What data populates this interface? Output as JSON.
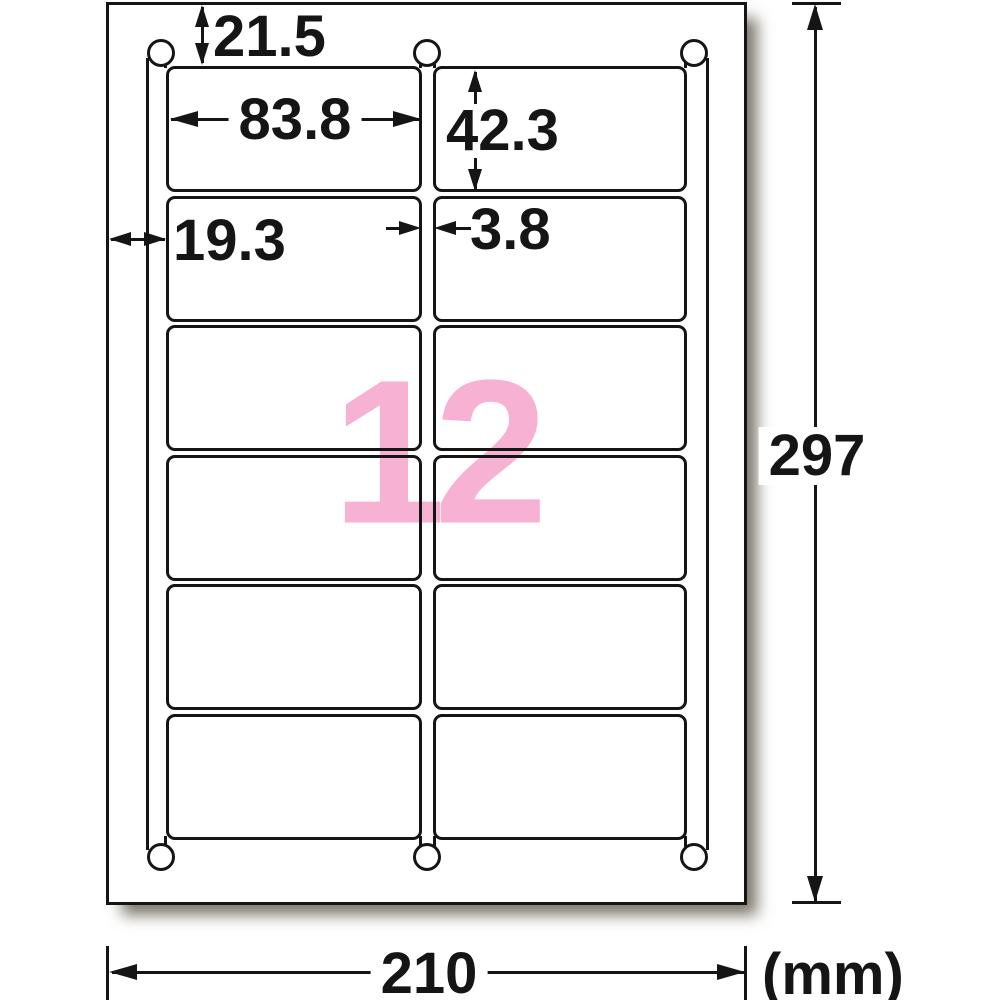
{
  "diagram": {
    "label_count": "12",
    "unit_label": "(mm)",
    "grid": {
      "rows": 6,
      "columns": 2
    },
    "dimensions": {
      "top_margin": "21.5",
      "label_width": "83.8",
      "label_height": "42.3",
      "left_margin": "19.3",
      "column_gap": "3.8",
      "sheet_height": "297",
      "sheet_width": "210"
    },
    "colors": {
      "line": "#151515",
      "count_pink": "#f6b1d3",
      "paper": "#ffffff"
    }
  }
}
